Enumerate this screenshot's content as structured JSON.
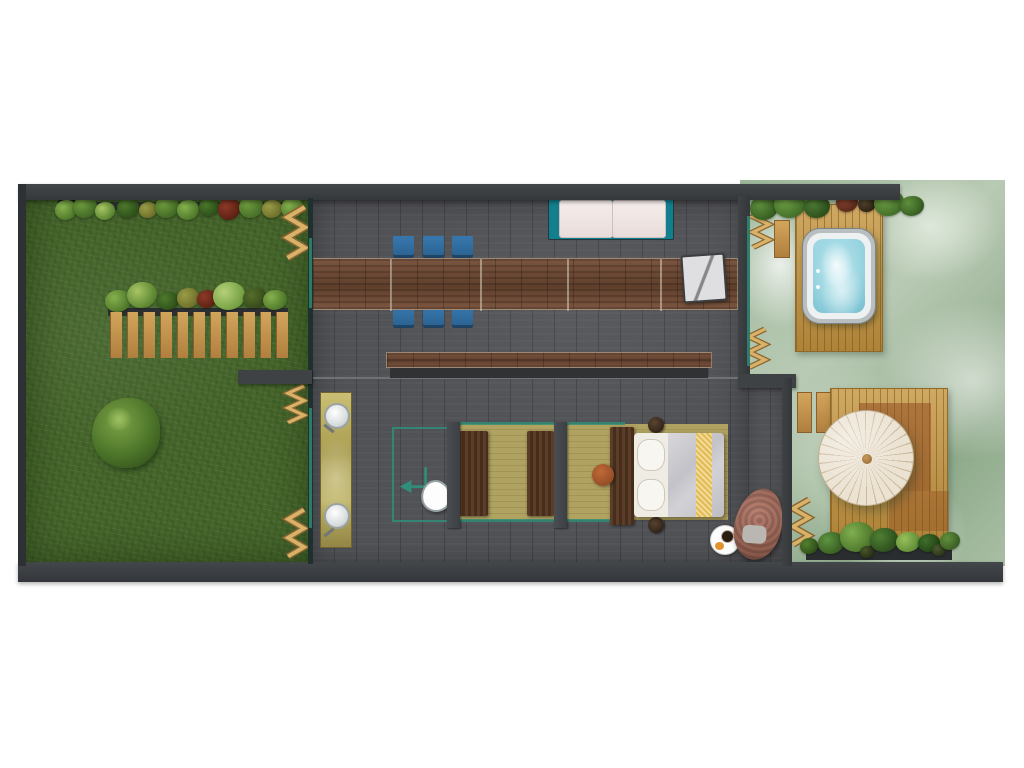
{
  "plan_type": "villa-floor-plan",
  "areas": [
    {
      "id": "garden",
      "label": "grass-garden"
    },
    {
      "id": "living-dining",
      "label": "open-living-dining-room"
    },
    {
      "id": "bathroom",
      "label": "vanity-shower-wc-zone"
    },
    {
      "id": "bedroom",
      "label": "bedroom-zone"
    },
    {
      "id": "hot-tub-terrace",
      "label": "hot-tub-deck-terrace"
    },
    {
      "id": "parasol-terrace",
      "label": "parasol-deck-terrace"
    }
  ],
  "furniture": [
    "planter-row",
    "bamboo-screen",
    "slatted-fence",
    "garden-bush",
    "dining-table",
    "dining-chair",
    "lounge-chair",
    "daybed",
    "low-bench",
    "vanity-double-sink",
    "shower-enclosure",
    "toilet",
    "wardrobe-panel",
    "tatami-mat",
    "double-bed",
    "bedside-lamp",
    "side-stool",
    "breakfast-tray",
    "hanging-egg-chair",
    "hot-tub",
    "timber-deck",
    "round-parasol",
    "flower-bed"
  ],
  "counts": {
    "dining_chairs": 6,
    "bamboo_screens": 6,
    "sinks": 2,
    "fence_planks": 11,
    "tatami_mats": 2,
    "bedside_lamps": 2
  },
  "colors": {
    "grass": "#46662b",
    "floor": "#515256",
    "wall": "#3a3d40",
    "table_wood": "#6d4936",
    "deck_wood": "#c4953f",
    "chair_blue": "#2e6da1",
    "daybed_teal": "#117f8e",
    "hot_tub_water": "#8ed0dd",
    "vanity_gold": "#b5a95e",
    "mat_khaki": "#b0a261",
    "bed_runner_gold": "#e3bb4e",
    "parasol_cream": "#ebe2d2",
    "mist_green": "#a7bba3",
    "shower_glass": "#2e8f78",
    "bamboo": "#d8b269"
  }
}
